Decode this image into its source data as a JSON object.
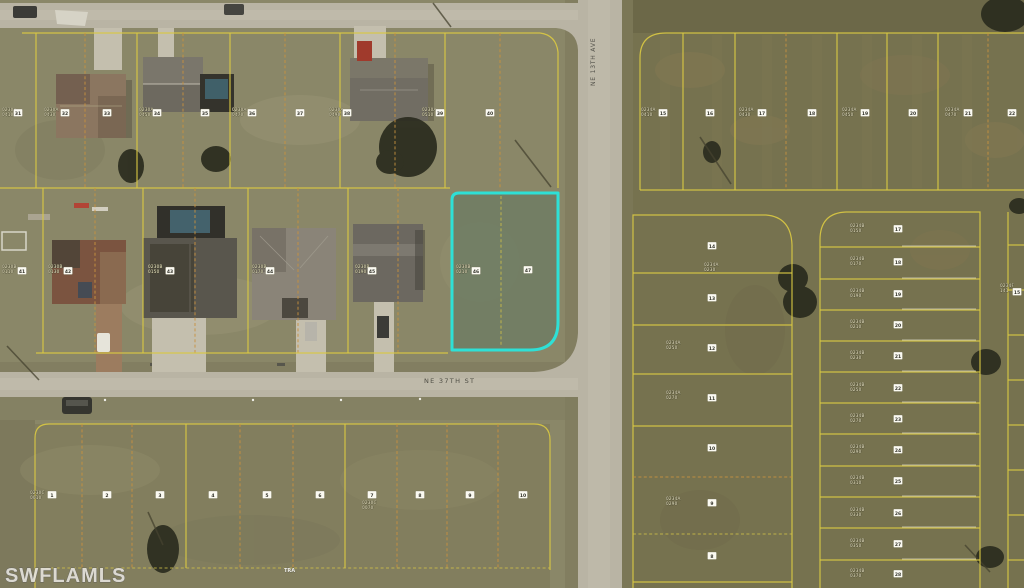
{
  "watermark": "SWFLAMLS",
  "streets": {
    "horizontal": "NE 37TH ST",
    "vertical": "NE 13TH AVE"
  },
  "tract_label": "TRA",
  "highlight": {
    "description": "subject-lot-outline",
    "color": "#2ee0d6"
  },
  "colors": {
    "plat_line_yellow": "#d9c843",
    "plat_line_orange_dashed": "#c8913e",
    "road_pavement": "#b9b4a4",
    "grass_left": "#8a8768",
    "grass_right": "#76724f",
    "highlight_cyan": "#2ee0d6",
    "marker_box_white": "#fbfaf2",
    "label_cream": "#f3edca"
  },
  "markers": {
    "numbers": [
      {
        "n": "31",
        "x": 18,
        "y": 113
      },
      {
        "n": "32",
        "x": 65,
        "y": 113
      },
      {
        "n": "33",
        "x": 107,
        "y": 113
      },
      {
        "n": "34",
        "x": 157,
        "y": 113
      },
      {
        "n": "35",
        "x": 205,
        "y": 113
      },
      {
        "n": "36",
        "x": 252,
        "y": 113
      },
      {
        "n": "37",
        "x": 300,
        "y": 113
      },
      {
        "n": "38",
        "x": 347,
        "y": 113
      },
      {
        "n": "39",
        "x": 440,
        "y": 113
      },
      {
        "n": "40",
        "x": 490,
        "y": 113
      },
      {
        "n": "41",
        "x": 22,
        "y": 271
      },
      {
        "n": "42",
        "x": 68,
        "y": 271
      },
      {
        "n": "43",
        "x": 170,
        "y": 271
      },
      {
        "n": "44",
        "x": 270,
        "y": 271
      },
      {
        "n": "45",
        "x": 372,
        "y": 271
      },
      {
        "n": "46",
        "x": 476,
        "y": 271
      },
      {
        "n": "47",
        "x": 528,
        "y": 270
      },
      {
        "n": "1",
        "x": 52,
        "y": 495
      },
      {
        "n": "2",
        "x": 107,
        "y": 495
      },
      {
        "n": "3",
        "x": 160,
        "y": 495
      },
      {
        "n": "4",
        "x": 213,
        "y": 495
      },
      {
        "n": "5",
        "x": 267,
        "y": 495
      },
      {
        "n": "6",
        "x": 320,
        "y": 495
      },
      {
        "n": "7",
        "x": 372,
        "y": 495
      },
      {
        "n": "8",
        "x": 420,
        "y": 495
      },
      {
        "n": "9",
        "x": 470,
        "y": 495
      },
      {
        "n": "10",
        "x": 523,
        "y": 495
      },
      {
        "n": "15",
        "x": 663,
        "y": 113
      },
      {
        "n": "16",
        "x": 710,
        "y": 113
      },
      {
        "n": "17",
        "x": 762,
        "y": 113
      },
      {
        "n": "18",
        "x": 812,
        "y": 113
      },
      {
        "n": "19",
        "x": 865,
        "y": 113
      },
      {
        "n": "20",
        "x": 913,
        "y": 113
      },
      {
        "n": "21",
        "x": 968,
        "y": 113
      },
      {
        "n": "22",
        "x": 1012,
        "y": 113
      },
      {
        "n": "14",
        "x": 712,
        "y": 246
      },
      {
        "n": "13",
        "x": 712,
        "y": 298
      },
      {
        "n": "12",
        "x": 712,
        "y": 348
      },
      {
        "n": "11",
        "x": 712,
        "y": 398
      },
      {
        "n": "10",
        "x": 712,
        "y": 448
      },
      {
        "n": "9",
        "x": 712,
        "y": 503
      },
      {
        "n": "8",
        "x": 712,
        "y": 556
      },
      {
        "n": "17",
        "x": 898,
        "y": 229
      },
      {
        "n": "18",
        "x": 898,
        "y": 262
      },
      {
        "n": "19",
        "x": 898,
        "y": 294
      },
      {
        "n": "20",
        "x": 898,
        "y": 325
      },
      {
        "n": "21",
        "x": 898,
        "y": 356
      },
      {
        "n": "22",
        "x": 898,
        "y": 388
      },
      {
        "n": "23",
        "x": 898,
        "y": 419
      },
      {
        "n": "24",
        "x": 898,
        "y": 450
      },
      {
        "n": "25",
        "x": 898,
        "y": 481
      },
      {
        "n": "26",
        "x": 898,
        "y": 513
      },
      {
        "n": "27",
        "x": 898,
        "y": 544
      },
      {
        "n": "28",
        "x": 898,
        "y": 574
      },
      {
        "n": "15",
        "x": 1017,
        "y": 292
      }
    ],
    "labels": [
      {
        "l1": "0230A",
        "l2": "0410",
        "x": 2,
        "y": 113
      },
      {
        "l1": "0230A",
        "l2": "0430",
        "x": 44,
        "y": 113
      },
      {
        "l1": "0230A",
        "l2": "0450",
        "x": 139,
        "y": 113
      },
      {
        "l1": "0230A",
        "l2": "0470",
        "x": 232,
        "y": 113
      },
      {
        "l1": "0230A",
        "l2": "0490",
        "x": 329,
        "y": 113
      },
      {
        "l1": "0230A",
        "l2": "0510",
        "x": 422,
        "y": 113
      },
      {
        "l1": "0230B",
        "l2": "0110",
        "x": 2,
        "y": 270
      },
      {
        "l1": "0230B",
        "l2": "0130",
        "x": 48,
        "y": 270
      },
      {
        "l1": "0230B",
        "l2": "0150",
        "x": 148,
        "y": 270
      },
      {
        "l1": "0230B",
        "l2": "0170",
        "x": 252,
        "y": 270
      },
      {
        "l1": "0230B",
        "l2": "0190",
        "x": 355,
        "y": 270
      },
      {
        "l1": "0230B",
        "l2": "0210",
        "x": 456,
        "y": 270
      },
      {
        "l1": "0230C",
        "l2": "0010",
        "x": 30,
        "y": 496
      },
      {
        "l1": "0230C",
        "l2": "0070",
        "x": 362,
        "y": 506
      },
      {
        "l1": "0234A",
        "l2": "0410",
        "x": 641,
        "y": 113
      },
      {
        "l1": "0234A",
        "l2": "0430",
        "x": 739,
        "y": 113
      },
      {
        "l1": "0234A",
        "l2": "0450",
        "x": 842,
        "y": 113
      },
      {
        "l1": "0234A",
        "l2": "0470",
        "x": 945,
        "y": 113
      },
      {
        "l1": "0234A",
        "l2": "0230",
        "x": 704,
        "y": 268
      },
      {
        "l1": "0234A",
        "l2": "0250",
        "x": 666,
        "y": 346
      },
      {
        "l1": "0234A",
        "l2": "0270",
        "x": 666,
        "y": 396
      },
      {
        "l1": "0234A",
        "l2": "0290",
        "x": 666,
        "y": 502
      },
      {
        "l1": "0234B",
        "l2": "0150",
        "x": 850,
        "y": 229
      },
      {
        "l1": "0234B",
        "l2": "0170",
        "x": 850,
        "y": 262
      },
      {
        "l1": "0234B",
        "l2": "0190",
        "x": 850,
        "y": 294
      },
      {
        "l1": "0234B",
        "l2": "0210",
        "x": 850,
        "y": 325
      },
      {
        "l1": "0234B",
        "l2": "0230",
        "x": 850,
        "y": 356
      },
      {
        "l1": "0234B",
        "l2": "0250",
        "x": 850,
        "y": 388
      },
      {
        "l1": "0234B",
        "l2": "0270",
        "x": 850,
        "y": 419
      },
      {
        "l1": "0234B",
        "l2": "0290",
        "x": 850,
        "y": 450
      },
      {
        "l1": "0234B",
        "l2": "0310",
        "x": 850,
        "y": 481
      },
      {
        "l1": "0234B",
        "l2": "0330",
        "x": 850,
        "y": 513
      },
      {
        "l1": "0234B",
        "l2": "0350",
        "x": 850,
        "y": 544
      },
      {
        "l1": "0234B",
        "l2": "0370",
        "x": 850,
        "y": 574
      },
      {
        "l1": "0234F",
        "l2": "141",
        "x": 1000,
        "y": 289
      }
    ]
  }
}
